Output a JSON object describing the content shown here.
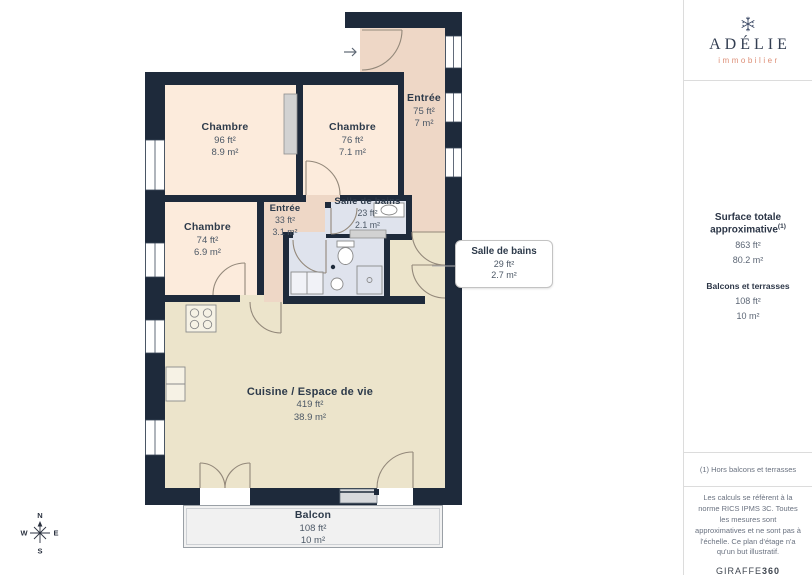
{
  "plan": {
    "rooms": {
      "entree_top": {
        "name": "Entrée",
        "ft": "75 ft²",
        "m": "7 m²"
      },
      "chambre1": {
        "name": "Chambre",
        "ft": "96 ft²",
        "m": "8.9 m²"
      },
      "chambre2": {
        "name": "Chambre",
        "ft": "76 ft²",
        "m": "7.1 m²"
      },
      "chambre3": {
        "name": "Chambre",
        "ft": "74 ft²",
        "m": "6.9 m²"
      },
      "entree_inner": {
        "name": "Entrée",
        "ft": "33 ft²",
        "m": "3.1 m²"
      },
      "sdb1": {
        "name": "Salle de bains",
        "ft": "23 ft²",
        "m": "2.1 m²"
      },
      "sdb2": {
        "name": "Salle de bains",
        "ft": "29 ft²",
        "m": "2.7 m²"
      },
      "cuisine": {
        "name": "Cuisine / Espace de vie",
        "ft": "419 ft²",
        "m": "38.9 m²"
      },
      "balcon": {
        "name": "Balcon",
        "ft": "108 ft²",
        "m": "10 m²"
      }
    },
    "compass": {
      "n": "N",
      "e": "E",
      "s": "S",
      "w": "W"
    }
  },
  "sidebar": {
    "logo": {
      "brand": "ADÉLIE",
      "tagline": "immobilier"
    },
    "summary": {
      "title": "Surface totale approximative",
      "title_sup": "(1)",
      "total_ft": "863 ft²",
      "total_m": "80.2 m²",
      "balconies_label": "Balcons et terrasses",
      "balconies_ft": "108 ft²",
      "balconies_m": "10 m²"
    },
    "footnote": "(1) Hors balcons et terrasses",
    "disclaimer": "Les calculs se réfèrent à la norme RICS IPMS 3C. Toutes les mesures sont approximatives et ne sont pas à l'échelle. Ce plan d'étage n'a qu'un but illustratif.",
    "vendor": {
      "name": "GIRAFFE",
      "suffix": "360"
    }
  },
  "colors": {
    "wall": "#1e2a3b",
    "room_peach": "#fcebdc",
    "room_salmon": "#eed7c6",
    "bathroom_blue": "#dfe3ed",
    "living_cream": "#ece4cb",
    "balcony_gray": "#f1f1f1",
    "brand_navy": "#333e52",
    "brand_salmon": "#dd8e76"
  }
}
